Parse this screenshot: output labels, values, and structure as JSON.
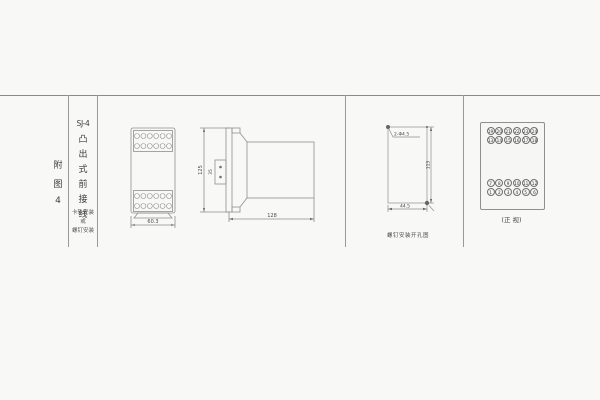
{
  "colors": {
    "background": "#f8f8f6",
    "line": "#8f8f8f",
    "text": "#4a4a4a"
  },
  "index_column": {
    "figure_label_chars": [
      "附",
      "图",
      "4"
    ]
  },
  "title_column": {
    "model": "SJ-4",
    "type_chars": [
      "凸",
      "出",
      "式",
      "前",
      "接",
      "线"
    ],
    "mount_lines": [
      "卡轨安装",
      "或",
      "螺钉安装"
    ]
  },
  "front_view": {
    "width_dim": "60.3"
  },
  "side_view": {
    "height_dim": "125",
    "clip_dim": "35",
    "depth_dim": "128"
  },
  "drill_view": {
    "hole_label": "2-Φ4.5",
    "vertical_dim": "113",
    "horizontal_dim": "44.5",
    "caption": "螺钉安装开孔图"
  },
  "terminal_view": {
    "caption": "(正 视)",
    "top_block": {
      "row1": [
        "19",
        "20",
        "21",
        "22",
        "23",
        "24"
      ],
      "row2": [
        "13",
        "14",
        "15",
        "16",
        "17",
        "18"
      ]
    },
    "bottom_block": {
      "row1": [
        "7",
        "8",
        "9",
        "10",
        "11",
        "12"
      ],
      "row2": [
        "1",
        "2",
        "3",
        "4",
        "5",
        "6"
      ]
    }
  }
}
